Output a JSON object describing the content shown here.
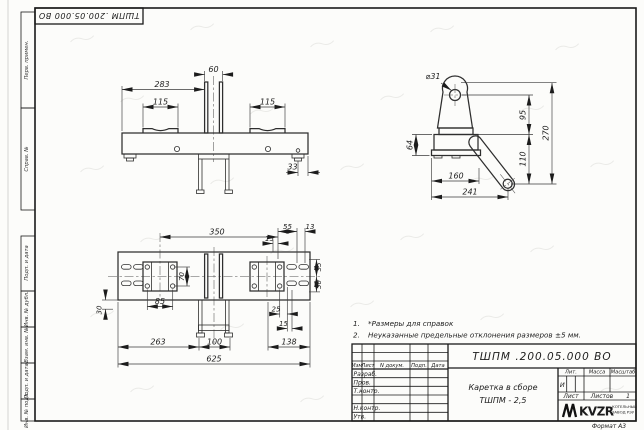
{
  "sheet": {
    "corner_code": "ТШПМ .200.05.000  ВО",
    "format_note": "Формат А3"
  },
  "margin_stamps": {
    "perv_primen": "Перв. примен.",
    "sprav_no": "Справ. №",
    "podp_data_1": "Подп. и дата",
    "inv_dubl": "Инв. № дубл.",
    "vzam_inv": "Взам. инв. №",
    "podp_data_2": "Подп. и дата",
    "inv_podl": "Инв. № подл."
  },
  "notes": {
    "n1_num": "1.",
    "n1_text": "*Размеры для справок",
    "n2_num": "2.",
    "n2_text": "Неуказанные предельные отклонения размеров  ±5 мм."
  },
  "front_view": {
    "d60": "60",
    "d283": "283",
    "d115_left": "115",
    "d115_right": "115",
    "d33": "33"
  },
  "side_view": {
    "dia31": "⌀31",
    "d95": "95",
    "d270": "270",
    "d110": "110",
    "d64": "64",
    "d160": "160",
    "d241": "241"
  },
  "plan_view": {
    "d350": "350",
    "d15_top": "15",
    "d55_top": "55",
    "d13": "13",
    "d70": "70",
    "d55_right": "55",
    "d50_right": "50",
    "d85": "85",
    "d25": "25",
    "d15_bottom": "15",
    "d30": "30",
    "d263": "263",
    "d100": "100",
    "d138": "138",
    "d625": "625"
  },
  "title_block": {
    "doc_code": "ТШПМ .200.05.000  ВО",
    "name_line1": "Каретка в сборе",
    "name_line2": "ТШПМ - 2,5",
    "col_izm": "Изм",
    "col_list": "Лист",
    "col_ndoc": "N докум.",
    "col_podp": "Подп.",
    "col_data": "Дата",
    "row_razrab": "Разраб.",
    "row_prov": "Пров.",
    "row_tkontr": "Т.контр.",
    "row_nkontr": "Н.контр.",
    "row_utv": "Утв.",
    "lit_label": "Лит.",
    "mass_label": "Масса",
    "scale_label": "Масштаб",
    "lit_value": "И",
    "sheet_label": "Лист",
    "sheets_label": "Листов",
    "sheets_value": "1",
    "logo_mark": "KVZR",
    "logo_line1": "КОТЕЛЬНЫЙ",
    "logo_line2": "ЗАВОД РЭУ"
  }
}
